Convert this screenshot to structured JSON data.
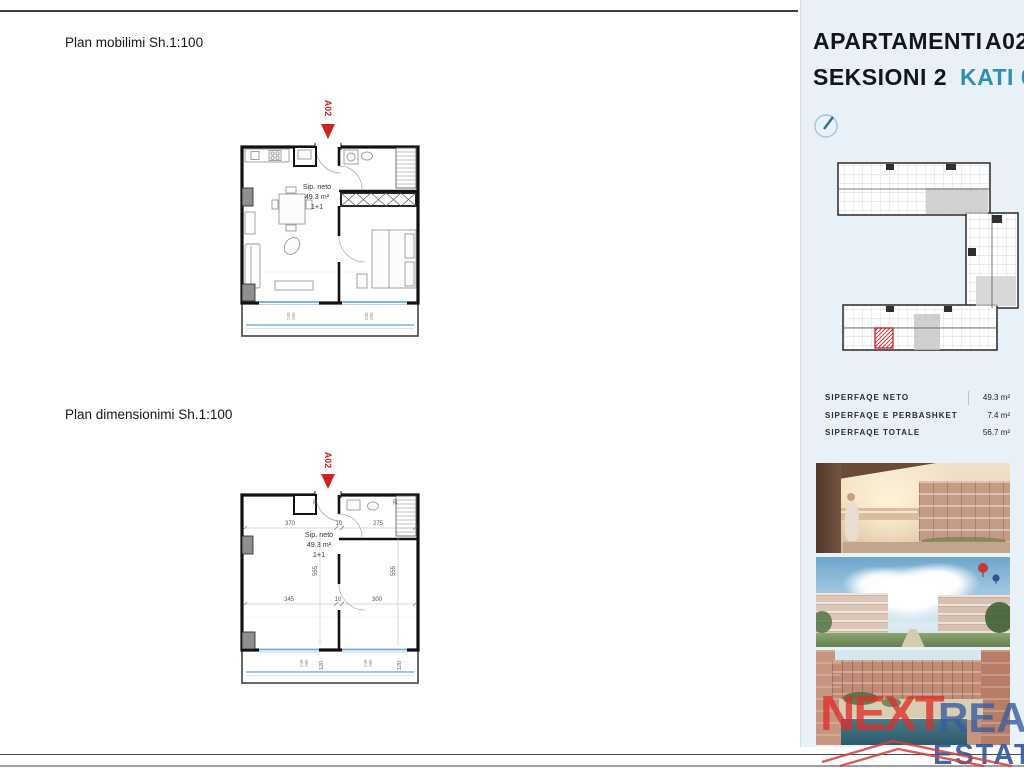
{
  "document": {
    "plan1_title": "Plan mobilimi Sh.1:100",
    "plan2_title": "Plan dimensionimi Sh.1:100",
    "marker": "A02",
    "sip": {
      "l1": "Sip. neto",
      "l2": "49.3 m²",
      "l3": "1+1"
    },
    "window_dims": {
      "w": "240",
      "h": "280"
    },
    "plan2_dims": {
      "top1": "370",
      "top2": "10",
      "top3": "275",
      "mid1": "345",
      "mid2": "10",
      "mid3": "300",
      "height": "555",
      "balcony_depth": "120",
      "wall": "20"
    }
  },
  "panel": {
    "title_word": "APARTAMENTI",
    "title_unit": "A02",
    "subtitle_word": "SEKSIONI 2",
    "subtitle_floor": "KATI 0",
    "accent_color": "#2e8fb5",
    "marker_red": "#cc2222",
    "background": "#e9f1f8",
    "areas": [
      {
        "label": "SIPERFAQE NETO",
        "value": "49.3 m²"
      },
      {
        "label": "SIPERFAQE E PERBASHKET",
        "value": "7.4 m²"
      },
      {
        "label": "SIPERFAQE TOTALE",
        "value": "56.7 m²"
      }
    ],
    "photos": [
      {
        "name": "balcony-sea-sunset-render"
      },
      {
        "name": "courtyard-balloons-render"
      },
      {
        "name": "pool-courtyard-render"
      }
    ],
    "logo": {
      "next": "NEXT",
      "real": "REAL",
      "estate": "ESTATE"
    }
  }
}
